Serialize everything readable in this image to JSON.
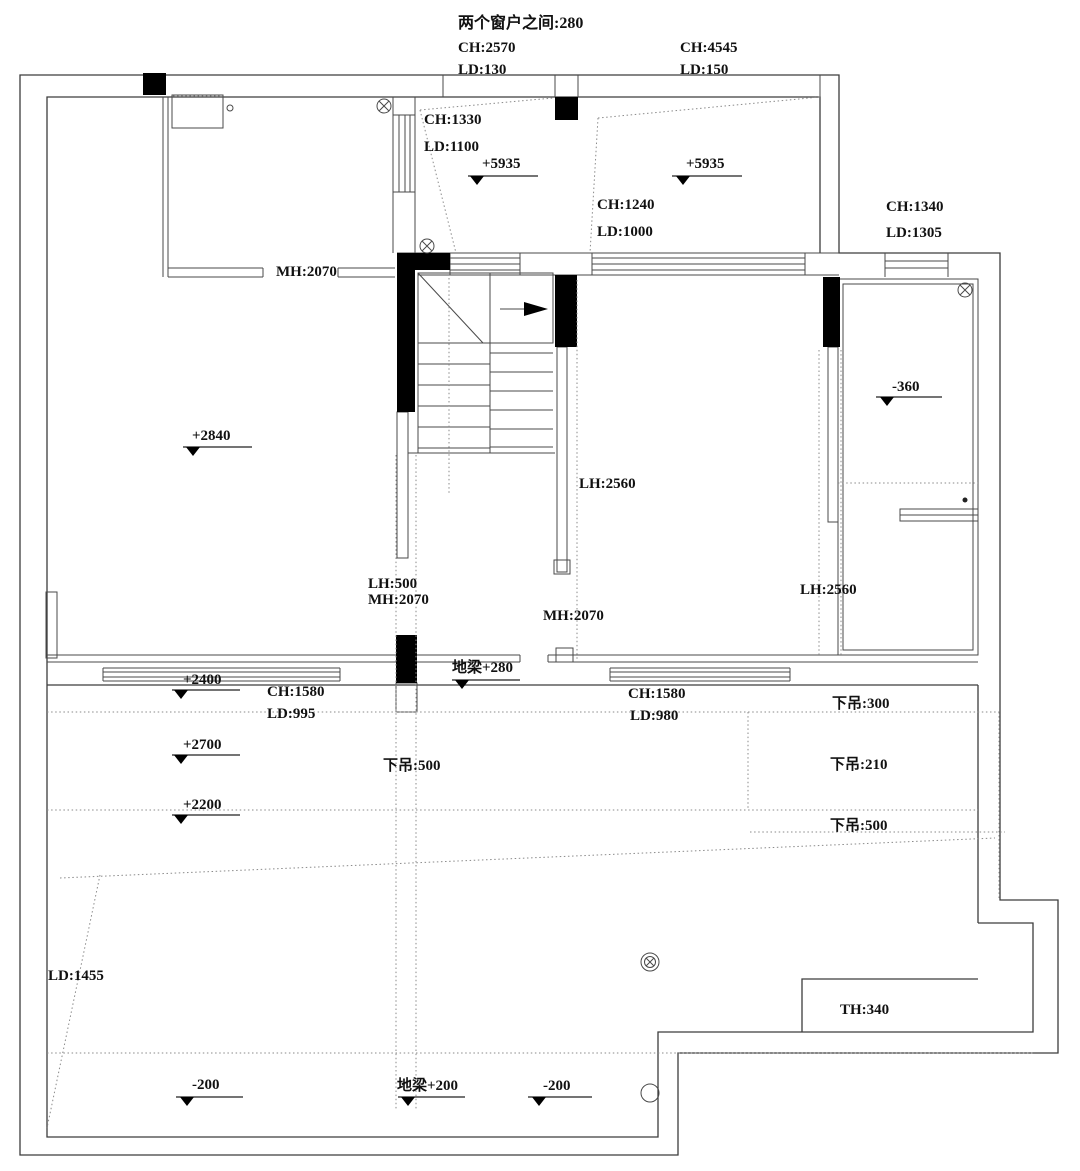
{
  "drawing": {
    "type": "floor-plan-ceiling-annotation",
    "units": "mm",
    "accent_color": "#000000",
    "line_color": "#3c3c3c"
  },
  "labels": {
    "title": "两个窗户之间:280",
    "win_left_ch": "CH:2570",
    "win_left_ld": "LD:130",
    "win_right_ch": "CH:4545",
    "win_right_ld": "LD:150",
    "stair_room_ch": "CH:1330",
    "stair_room_ld": "LD:1100",
    "lvl_5935_a": "+5935",
    "lvl_5935_b": "+5935",
    "mid_room_ch": "CH:1240",
    "mid_room_ld": "LD:1000",
    "tr_room_ch": "CH:1340",
    "tr_room_ld": "LD:1305",
    "mh_top": "MH:2070",
    "lvl_2840": "+2840",
    "neg_360": "-360",
    "lh_2560_a": "LH:2560",
    "lh_2560_b": "LH:2560",
    "lh_500": "LH:500",
    "mh_mid": "MH:2070",
    "mh_center": "MH:2070",
    "diliang_280": "地梁+280",
    "lvl_2400": "+2400",
    "ch_1580_left": "CH:1580",
    "ld_995": "LD:995",
    "lvl_2700": "+2700",
    "lvl_2200": "+2200",
    "xiadiao_500_left": "下吊:500",
    "ch_1580_right": "CH:1580",
    "ld_980": "LD:980",
    "xiadiao_300": "下吊:300",
    "xiadiao_210": "下吊:210",
    "xiadiao_500_right": "下吊:500",
    "ld_1455": "LD:1455",
    "th_340": "TH:340",
    "neg_200_a": "-200",
    "diliang_200": "地梁+200",
    "neg_200_b": "-200"
  }
}
